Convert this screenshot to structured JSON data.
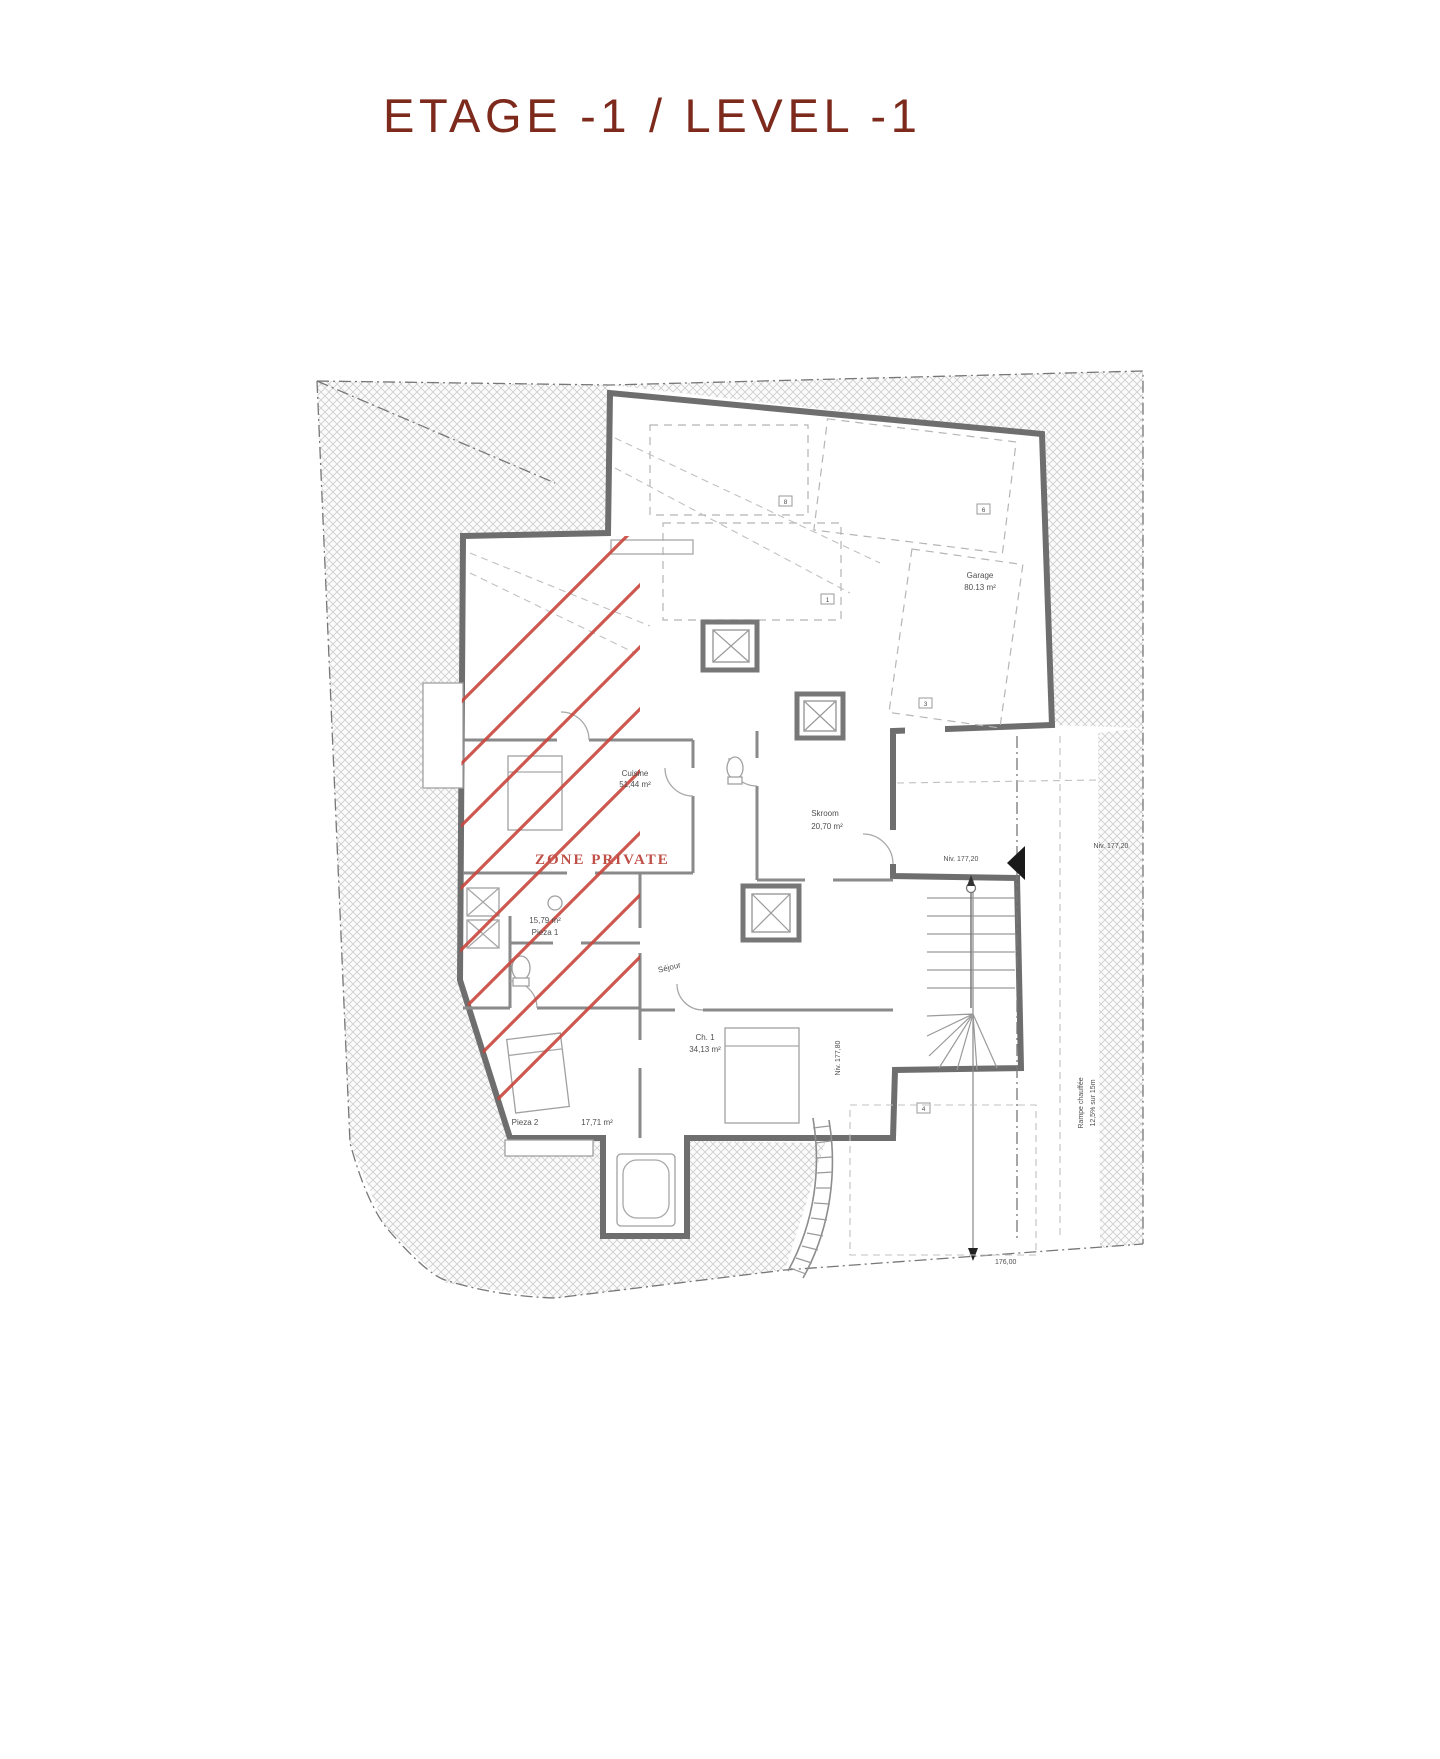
{
  "page": {
    "title": "ETAGE -1 / LEVEL -1"
  },
  "plan": {
    "zone_label": "ZONE PRIVATE",
    "rooms": {
      "garage": {
        "name": "Garage",
        "area": "80.13 m²"
      },
      "cuisine": {
        "name": "Cuisine",
        "area": "51,44 m²"
      },
      "skroom": {
        "name": "Skroom",
        "area": "20,70 m²"
      },
      "pieza1": {
        "name": "Pieza 1",
        "area": "15,79 m²"
      },
      "sejour": {
        "name": "Séjour"
      },
      "ch1": {
        "name": "Ch. 1",
        "area": "34,13 m²"
      },
      "pieza2": {
        "name": "Pieza 2",
        "area": "17,71 m²"
      }
    },
    "levels": {
      "entry_left": "Niv. 177,20",
      "entry_right": "Niv. 177,20",
      "lower": "Niv. 177,80",
      "bottom": "176,00"
    },
    "ramp": {
      "line1": "Rampe chauffée",
      "line2": "12,5% sur 15m"
    },
    "markers": {
      "m8": "8",
      "m6": "6",
      "m1": "1",
      "m3": "3",
      "m4": "4"
    },
    "colors": {
      "title": "#7d2a1c",
      "zone_text": "#bf4f47",
      "red_hatch": "#c8463c",
      "walls": "#6e6e6e"
    }
  }
}
